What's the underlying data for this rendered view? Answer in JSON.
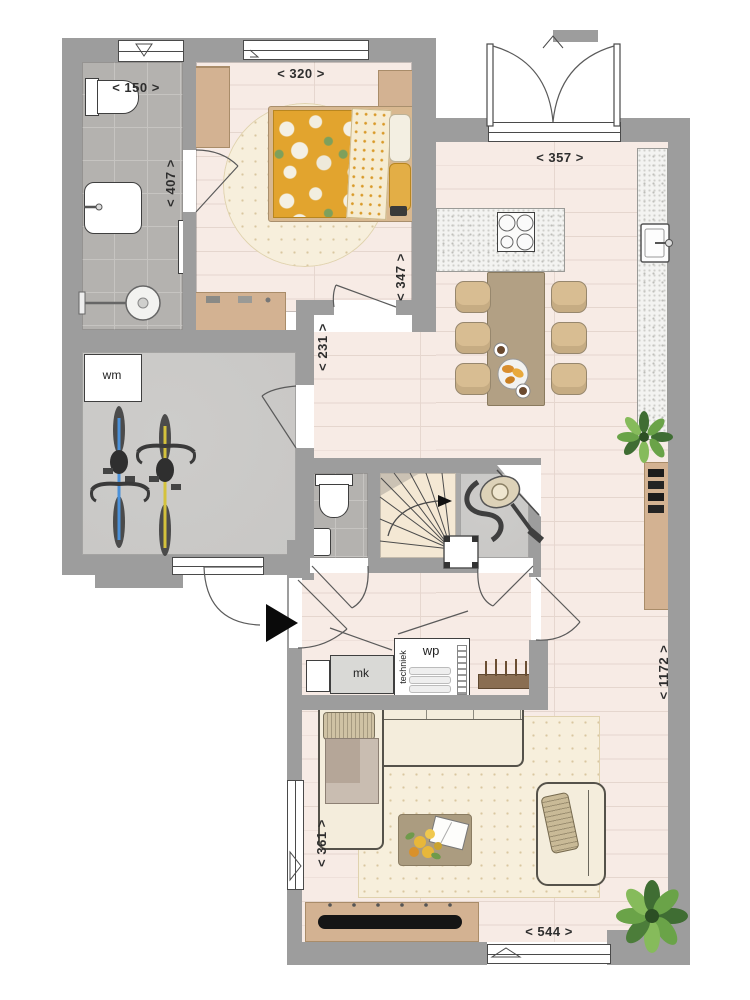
{
  "dimensions": {
    "bathroom_width": "< 150 >",
    "bedroom_width": "< 320 >",
    "bathroom_depth": "< 407 >",
    "bedroom_depth": "< 347 >",
    "kitchen_width": "< 357 >",
    "hall_depth": "< 231 >",
    "living_depth": "< 1172 >",
    "living_width": "< 361 >",
    "living_bottom_width": "< 544 >"
  },
  "room_labels": {
    "washing_machine": "wm",
    "meter_cupboard": "mk",
    "heat_pump": "wp",
    "technical_room": "techniek"
  },
  "colors": {
    "wall": "#9d9d9d",
    "wood": "#f7ebe5",
    "plank_line": "#e5d6ce",
    "tile": "#b4b2af",
    "concrete": "#c8c7c5",
    "rug": "#f7efdc",
    "cream": "#f4eddc",
    "tan": "#d3b292",
    "table_brown": "#b2a084",
    "chair": "#d8bd92",
    "counter": "#f3f3f1",
    "duvet_yellow": "#e2a42e",
    "polka_cream": "#f6ecd2",
    "outline": "#4c4c4c",
    "plant_green": "#5d9140",
    "arrow_black": "#0a0a0a"
  }
}
